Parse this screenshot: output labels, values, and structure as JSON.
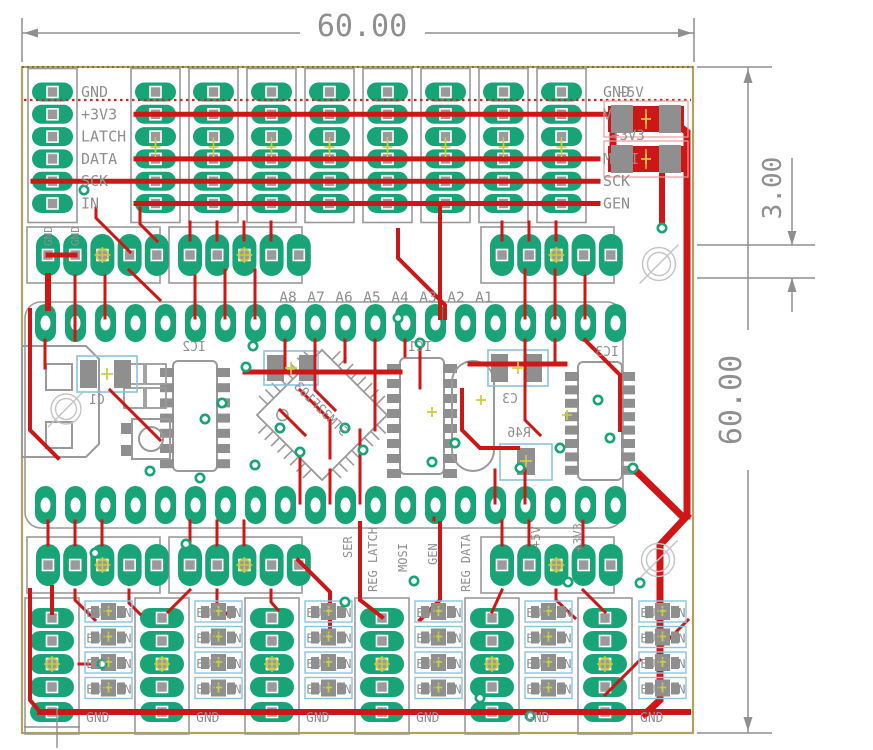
{
  "dimensions": {
    "width_mm": "60.00",
    "height_mm": "60.00",
    "hole_mm": "3.00"
  },
  "colors": {
    "pad_green": "#18A476",
    "trace_red": "#CE1616",
    "ratsnest_red": "#D42020",
    "silk_gray": "#9A9A9A",
    "smd_gray": "#8F8F8F",
    "text_gray": "#8F8F8F",
    "outline_blue": "#8CC3DF",
    "marker_yellow": "#C9CE3F",
    "board_edge": "#B5A15F",
    "dim_gray": "#8F8F8F",
    "hole_gray": "#C4C4C4"
  },
  "top_header": {
    "left_labels": [
      "GND",
      "+3V3",
      "LATCH",
      "DATA",
      "SCK",
      "IN"
    ],
    "right_labels": [
      "GND",
      "Vcc",
      "",
      "MOSI",
      "SCK",
      "GEN"
    ],
    "power_labels": [
      "+5V",
      "+3V3"
    ],
    "columns": 9,
    "rows": 6
  },
  "mid_top": {
    "gnd_labels": [
      "GND",
      "GND"
    ],
    "analog_labels": [
      "A8",
      "A7",
      "A6",
      "A5",
      "A4",
      "A3",
      "A2",
      "A1"
    ],
    "blocks": 3,
    "pads_per_block": 5
  },
  "module": {
    "top_row_pads": 20,
    "bottom_row_pads": 20,
    "ic_labels": [
      "IC2",
      "IC1",
      "IC3"
    ],
    "part_labels": [
      "C1",
      "C3",
      "R46"
    ],
    "mcu_label": "STM32F103"
  },
  "mid_bottom": {
    "signal_labels": [
      "SER",
      "REG LATCH",
      "MOSI",
      "GEN",
      "REG DATA",
      "+5V",
      "+3V3"
    ],
    "blocks": 3,
    "pads_per_block": 5
  },
  "bottom": {
    "units": 6,
    "button_label": "BUTTON",
    "buttons_per_unit": 4,
    "gnd_label": "GND",
    "pads_per_block": 5
  }
}
